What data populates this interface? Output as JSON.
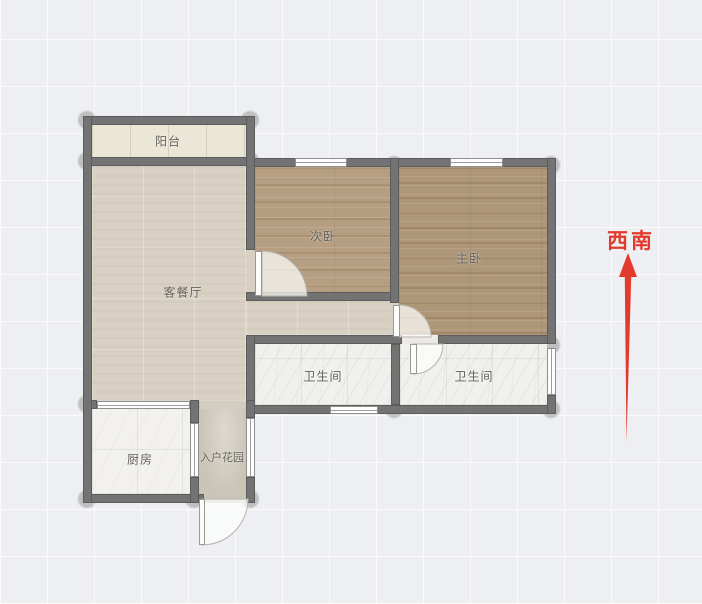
{
  "title": "户型图",
  "compass": {
    "label": "西南",
    "color": "#e23a2c"
  },
  "rooms": {
    "balcony": {
      "label": "阳台"
    },
    "living": {
      "label": "客餐厅"
    },
    "bedroom_second": {
      "label": "次卧"
    },
    "bedroom_master": {
      "label": "主卧"
    },
    "bathroom_1": {
      "label": "卫生间"
    },
    "bathroom_2": {
      "label": "卫生间"
    },
    "kitchen": {
      "label": "厨房"
    },
    "entry_garden": {
      "label": "入户花园"
    }
  },
  "palette": {
    "background": "#edeff2",
    "grid_line": "#ffffff",
    "wall": "#737373",
    "balcony_floor": "#ebe7d6",
    "living_floor": "#d8d0c3",
    "bedroom_second_floor": "#b59e81",
    "bedroom_master_floor": "#ae9678",
    "bathroom_floor": "#f0f0ed",
    "kitchen_floor": "#f2f1ee",
    "garden_floor": "#cbc5b8",
    "compass_red": "#e23a2c"
  }
}
